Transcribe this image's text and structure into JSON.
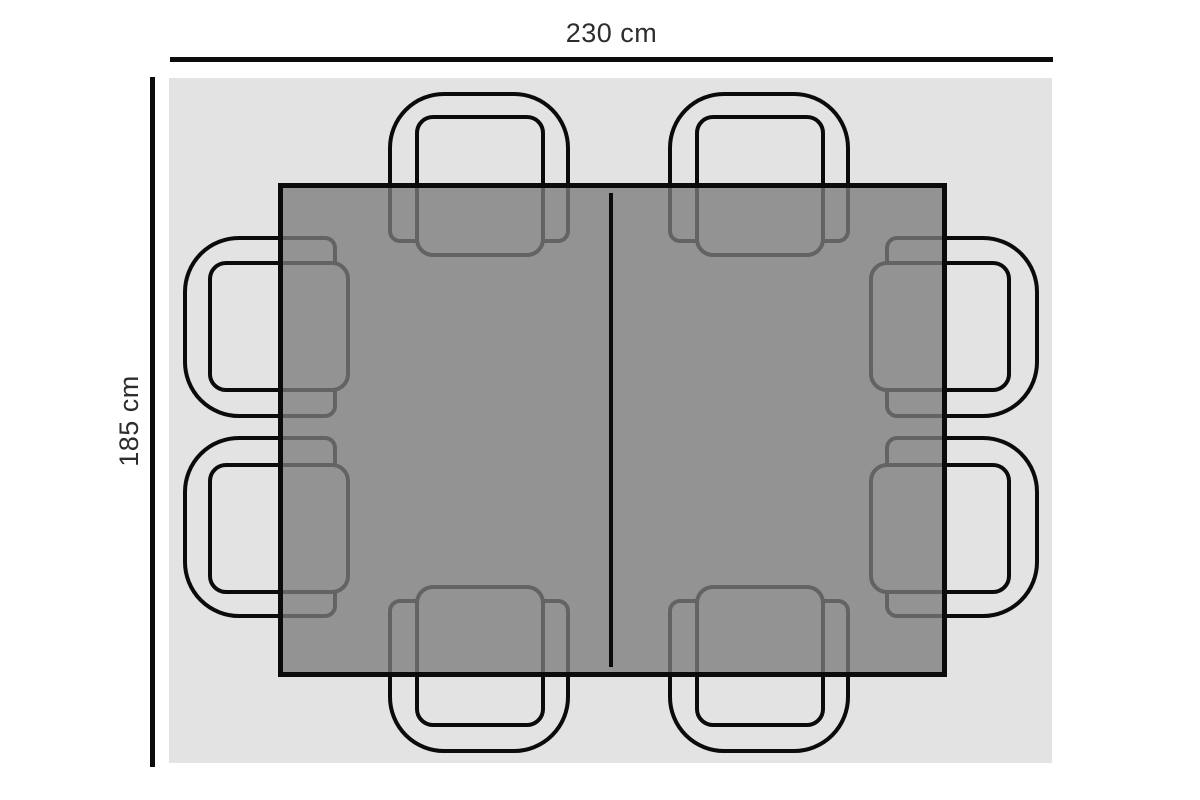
{
  "diagram": {
    "title": "Table with chairs - top view dimension diagram",
    "width_label": "230 cm",
    "height_label": "185 cm",
    "chair_count": 8,
    "colors": {
      "page_bg": "#ffffff",
      "area_bg": "#e3e3e3",
      "table_fill": "rgba(124,124,124,0.78)",
      "outline": "#0b0b0b",
      "label_text": "#2d2d2d"
    }
  }
}
